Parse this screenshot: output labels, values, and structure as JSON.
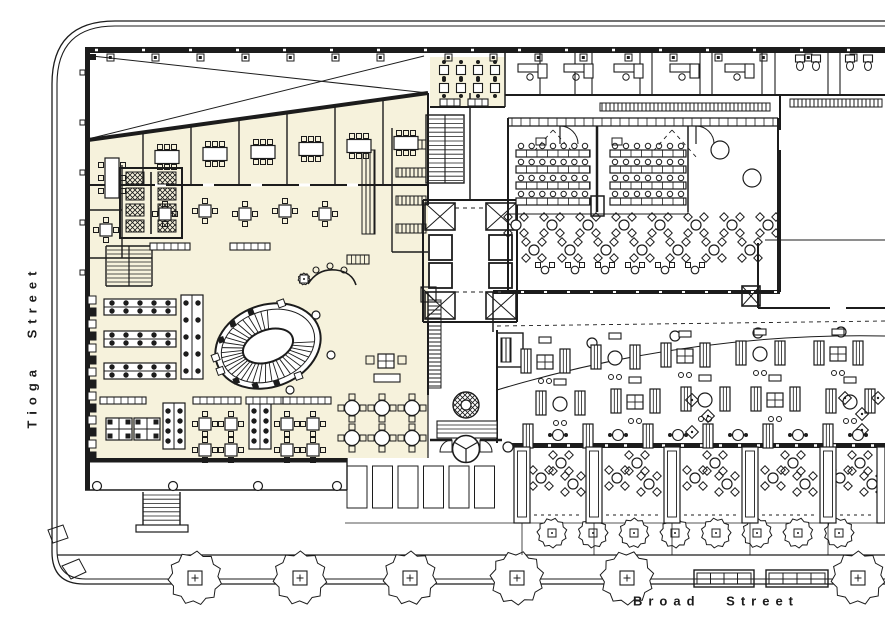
{
  "plan": {
    "streets": {
      "left_label": "Tioga Street",
      "bottom_label": "Broad Street"
    },
    "features": {
      "highlighted_zone": "tenant office area",
      "oval_stair": "oval monumental stair",
      "trees": "street trees",
      "elevators": "elevator core"
    }
  },
  "colors": {
    "paper": "#ffffff",
    "ink": "#1c1c1c",
    "highlight": "#f6f2dc"
  }
}
